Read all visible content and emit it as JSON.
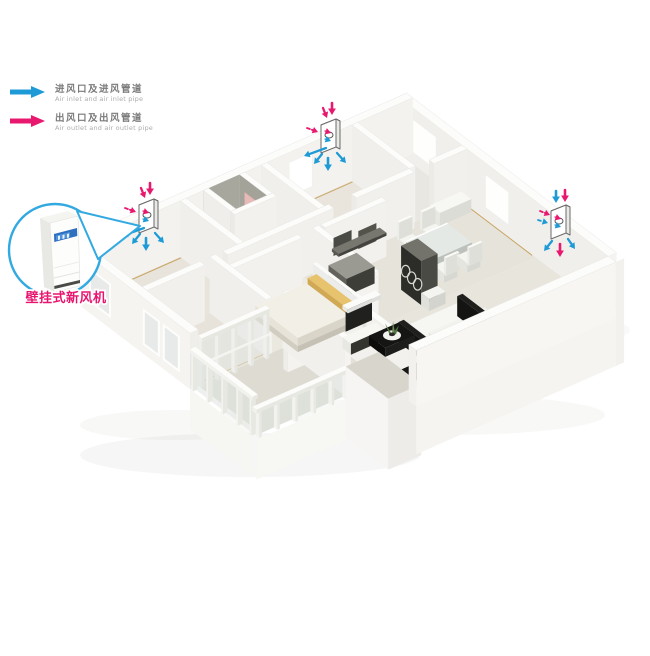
{
  "legend": {
    "items": [
      {
        "id": "inlet",
        "zh": "进风口及进风管道",
        "en": "Air inlet and air inlet pipe",
        "color": "#1e9bd7"
      },
      {
        "id": "outlet",
        "zh": "出风口及出风管道",
        "en": "Air outlet and air outlet pipe",
        "color": "#e9186f"
      }
    ]
  },
  "callout": {
    "label": "壁挂式新风机",
    "device": "wall-mounted-fresh-air-unit"
  },
  "units": [
    {
      "id": "bedroom-left-unit",
      "x": 148,
      "y": 218,
      "style": "default"
    },
    {
      "id": "bedroom-top-unit",
      "x": 330,
      "y": 138,
      "style": "default"
    },
    {
      "id": "dining-right-unit",
      "x": 560,
      "y": 224,
      "style": "mixed"
    }
  ],
  "colors": {
    "inlet_blue": "#1e9bd7",
    "outlet_pink": "#e9186f",
    "callout_blue": "#32a9e0",
    "label_pink": "#e8156f"
  }
}
